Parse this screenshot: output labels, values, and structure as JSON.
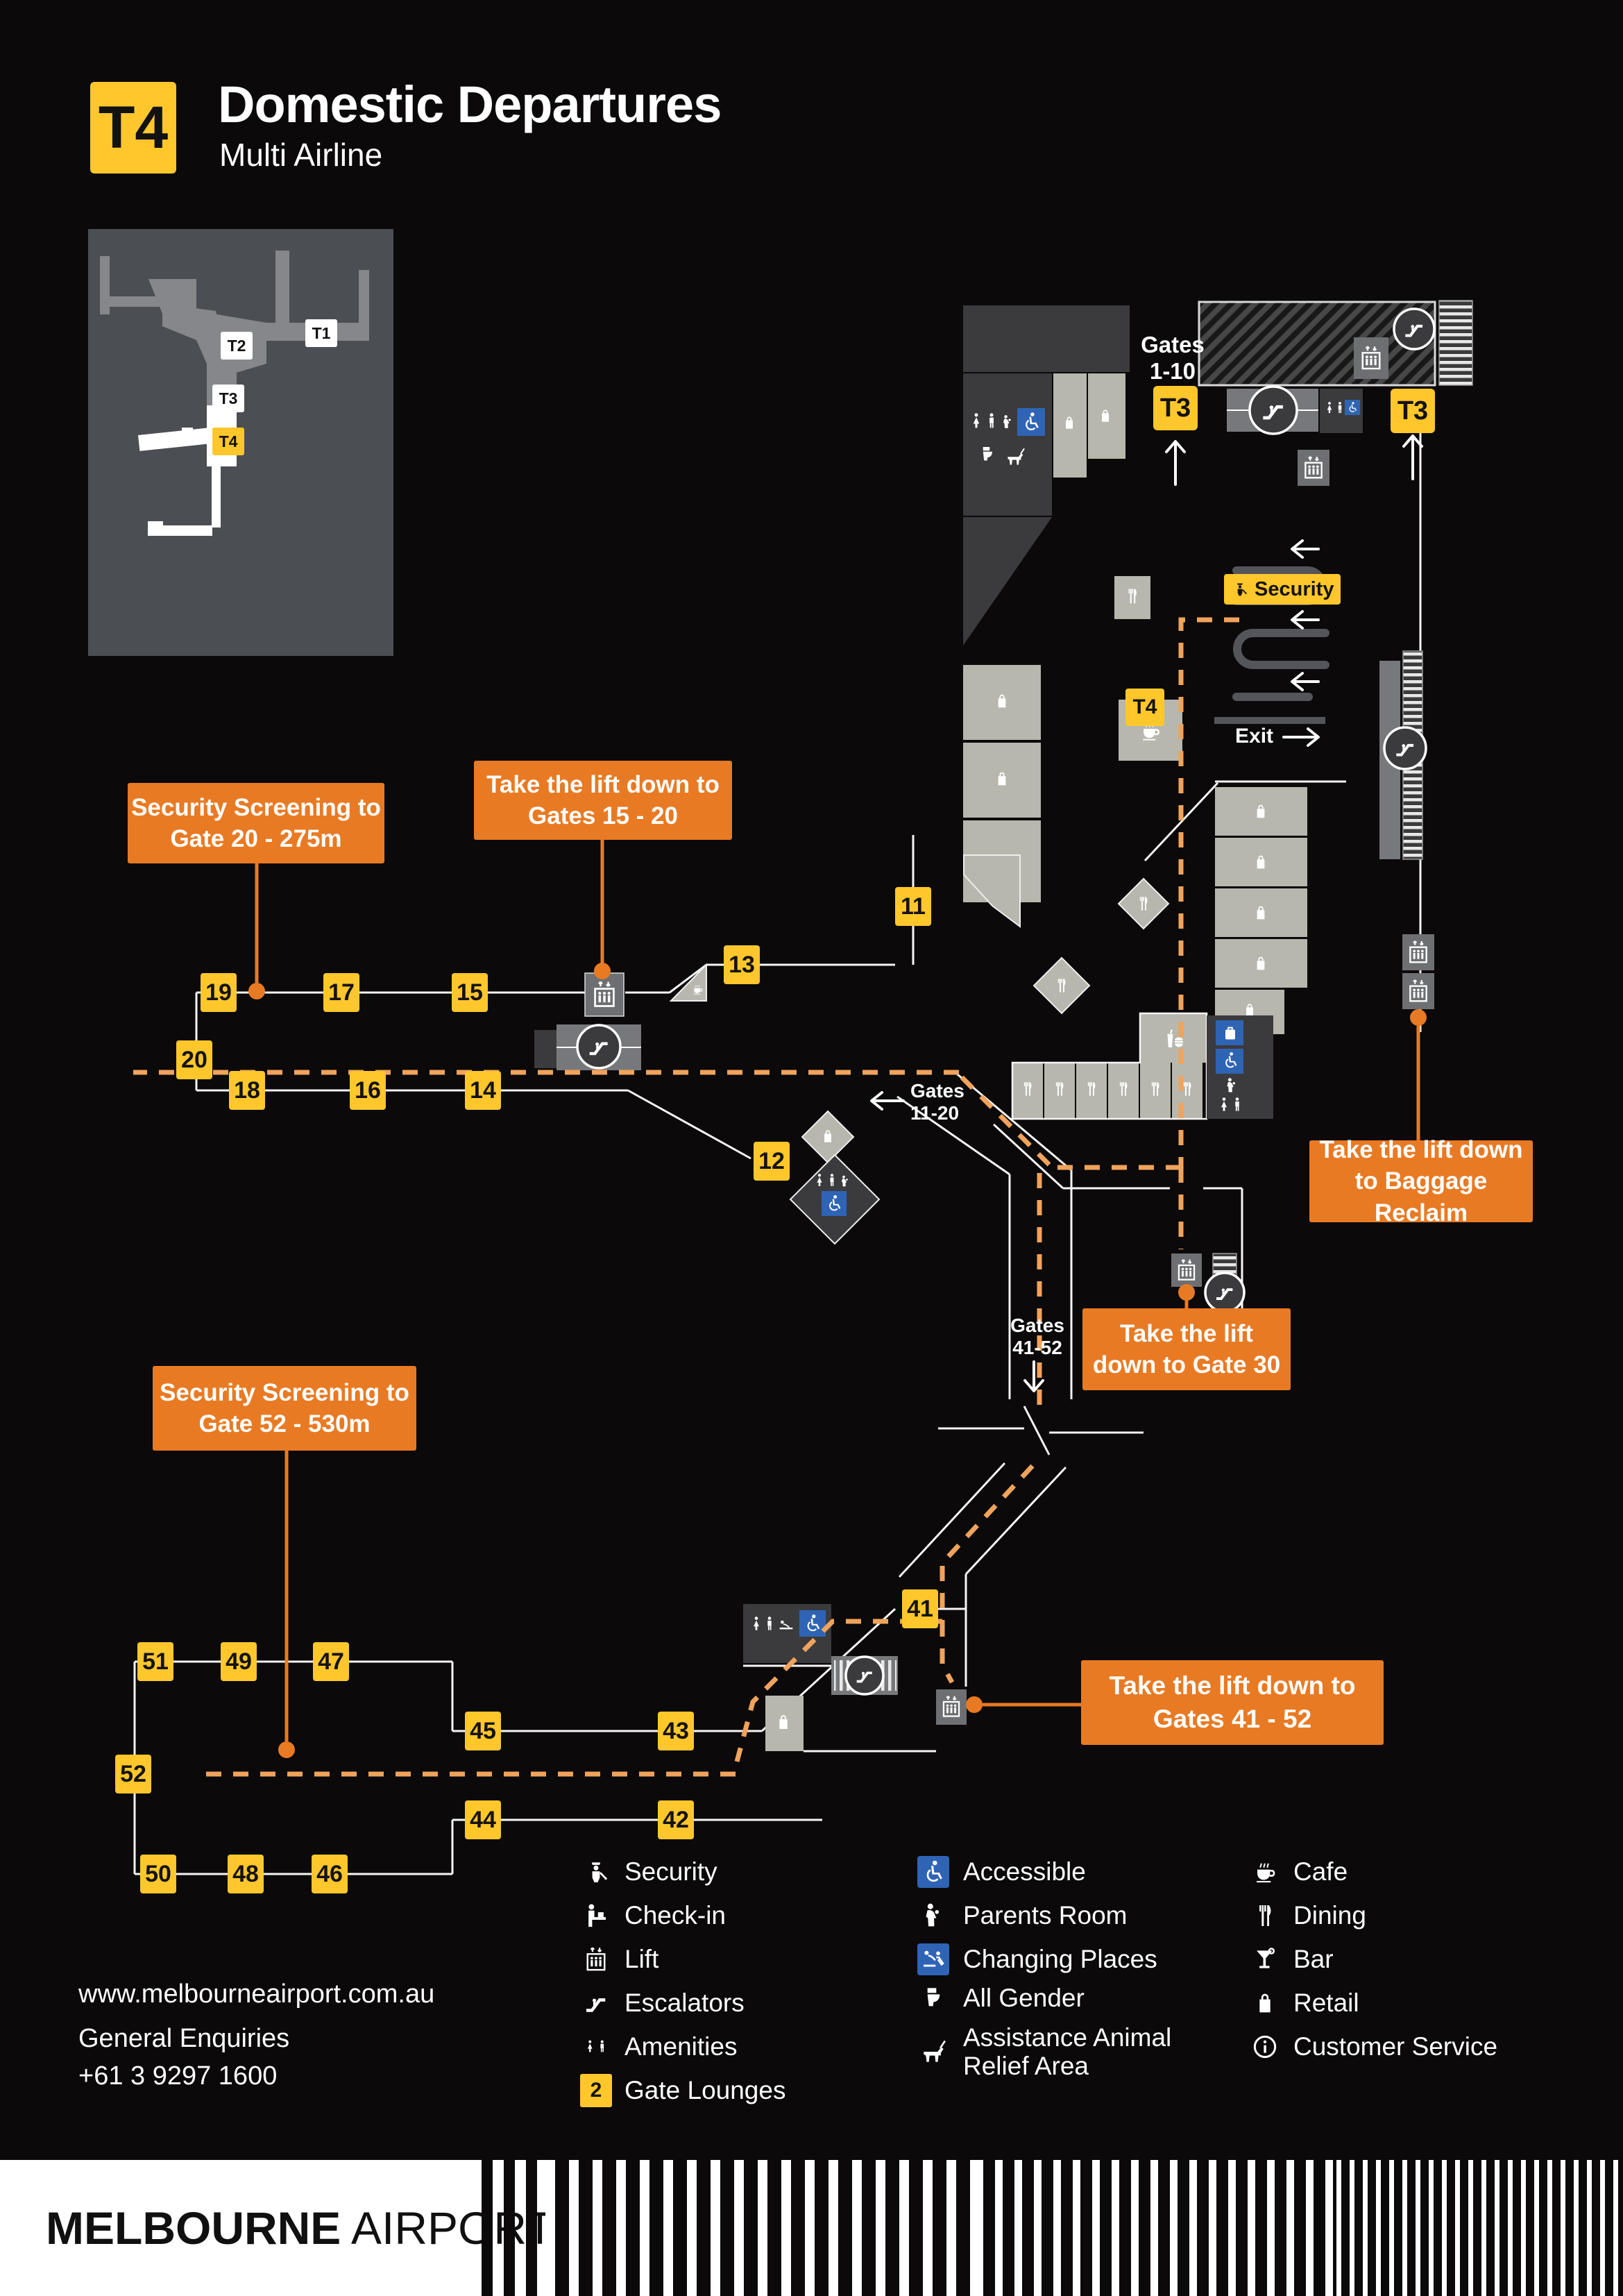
{
  "header": {
    "badge": "T4",
    "title": "Domestic Departures",
    "subtitle": "Multi Airline"
  },
  "minimap": {
    "t1": "T1",
    "t2": "T2",
    "t3": "T3",
    "t4": "T4"
  },
  "map": {
    "gates_1_10_l1": "Gates",
    "gates_1_10_l2": "1-10",
    "t3_left": "T3",
    "t3_right": "T3",
    "t4_badge": "T4",
    "security_label": "Security",
    "exit_label": "Exit",
    "gates_11_20_l1": "Gates",
    "gates_11_20_l2": "11-20",
    "gates_41_52_l1": "Gates",
    "gates_41_52_l2": "41-52",
    "gates": {
      "g11": "11",
      "g12": "12",
      "g13": "13",
      "g14": "14",
      "g15": "15",
      "g16": "16",
      "g17": "17",
      "g18": "18",
      "g19": "19",
      "g20": "20",
      "g41": "41",
      "g42": "42",
      "g43": "43",
      "g44": "44",
      "g45": "45",
      "g46": "46",
      "g47": "47",
      "g48": "48",
      "g49": "49",
      "g50": "50",
      "g51": "51",
      "g52": "52"
    },
    "callouts": {
      "sec20_l1": "Security Screening to",
      "sec20_l2": "Gate 20 - 275m",
      "lift1520_l1": "Take the lift down to",
      "lift1520_l2": "Gates 15 - 20",
      "baggage_l1": "Take the lift down",
      "baggage_l2": "to Baggage Reclaim",
      "gate30_l1": "Take the lift",
      "gate30_l2": "down to Gate 30",
      "sec52_l1": "Security Screening to",
      "sec52_l2": "Gate 52 - 530m",
      "lift4152_l1": "Take the lift down to",
      "lift4152_l2": "Gates 41 - 52"
    }
  },
  "legend": {
    "col1": [
      "Security",
      "Check-in",
      "Lift",
      "Escalators",
      "Amenities",
      "Gate Lounges"
    ],
    "gate_lounge_badge": "2",
    "col2": [
      "Accessible",
      "Parents Room",
      "Changing Places",
      "All Gender",
      "Assistance Animal",
      "Relief Area"
    ],
    "col3": [
      "Cafe",
      "Dining",
      "Bar",
      "Retail",
      "Customer Service"
    ]
  },
  "contact": {
    "website": "www.melbourneairport.com.au",
    "line1": "General Enquiries",
    "line2": "+61 3 9297 1600"
  },
  "footer": {
    "brand_bold": "MELBOURNE",
    "brand_light": "AIRPORT"
  },
  "colors": {
    "yellow": "#FFC72C",
    "orange": "#E87A24",
    "dashed": "#F0A35C",
    "blue": "#2F64B5"
  }
}
